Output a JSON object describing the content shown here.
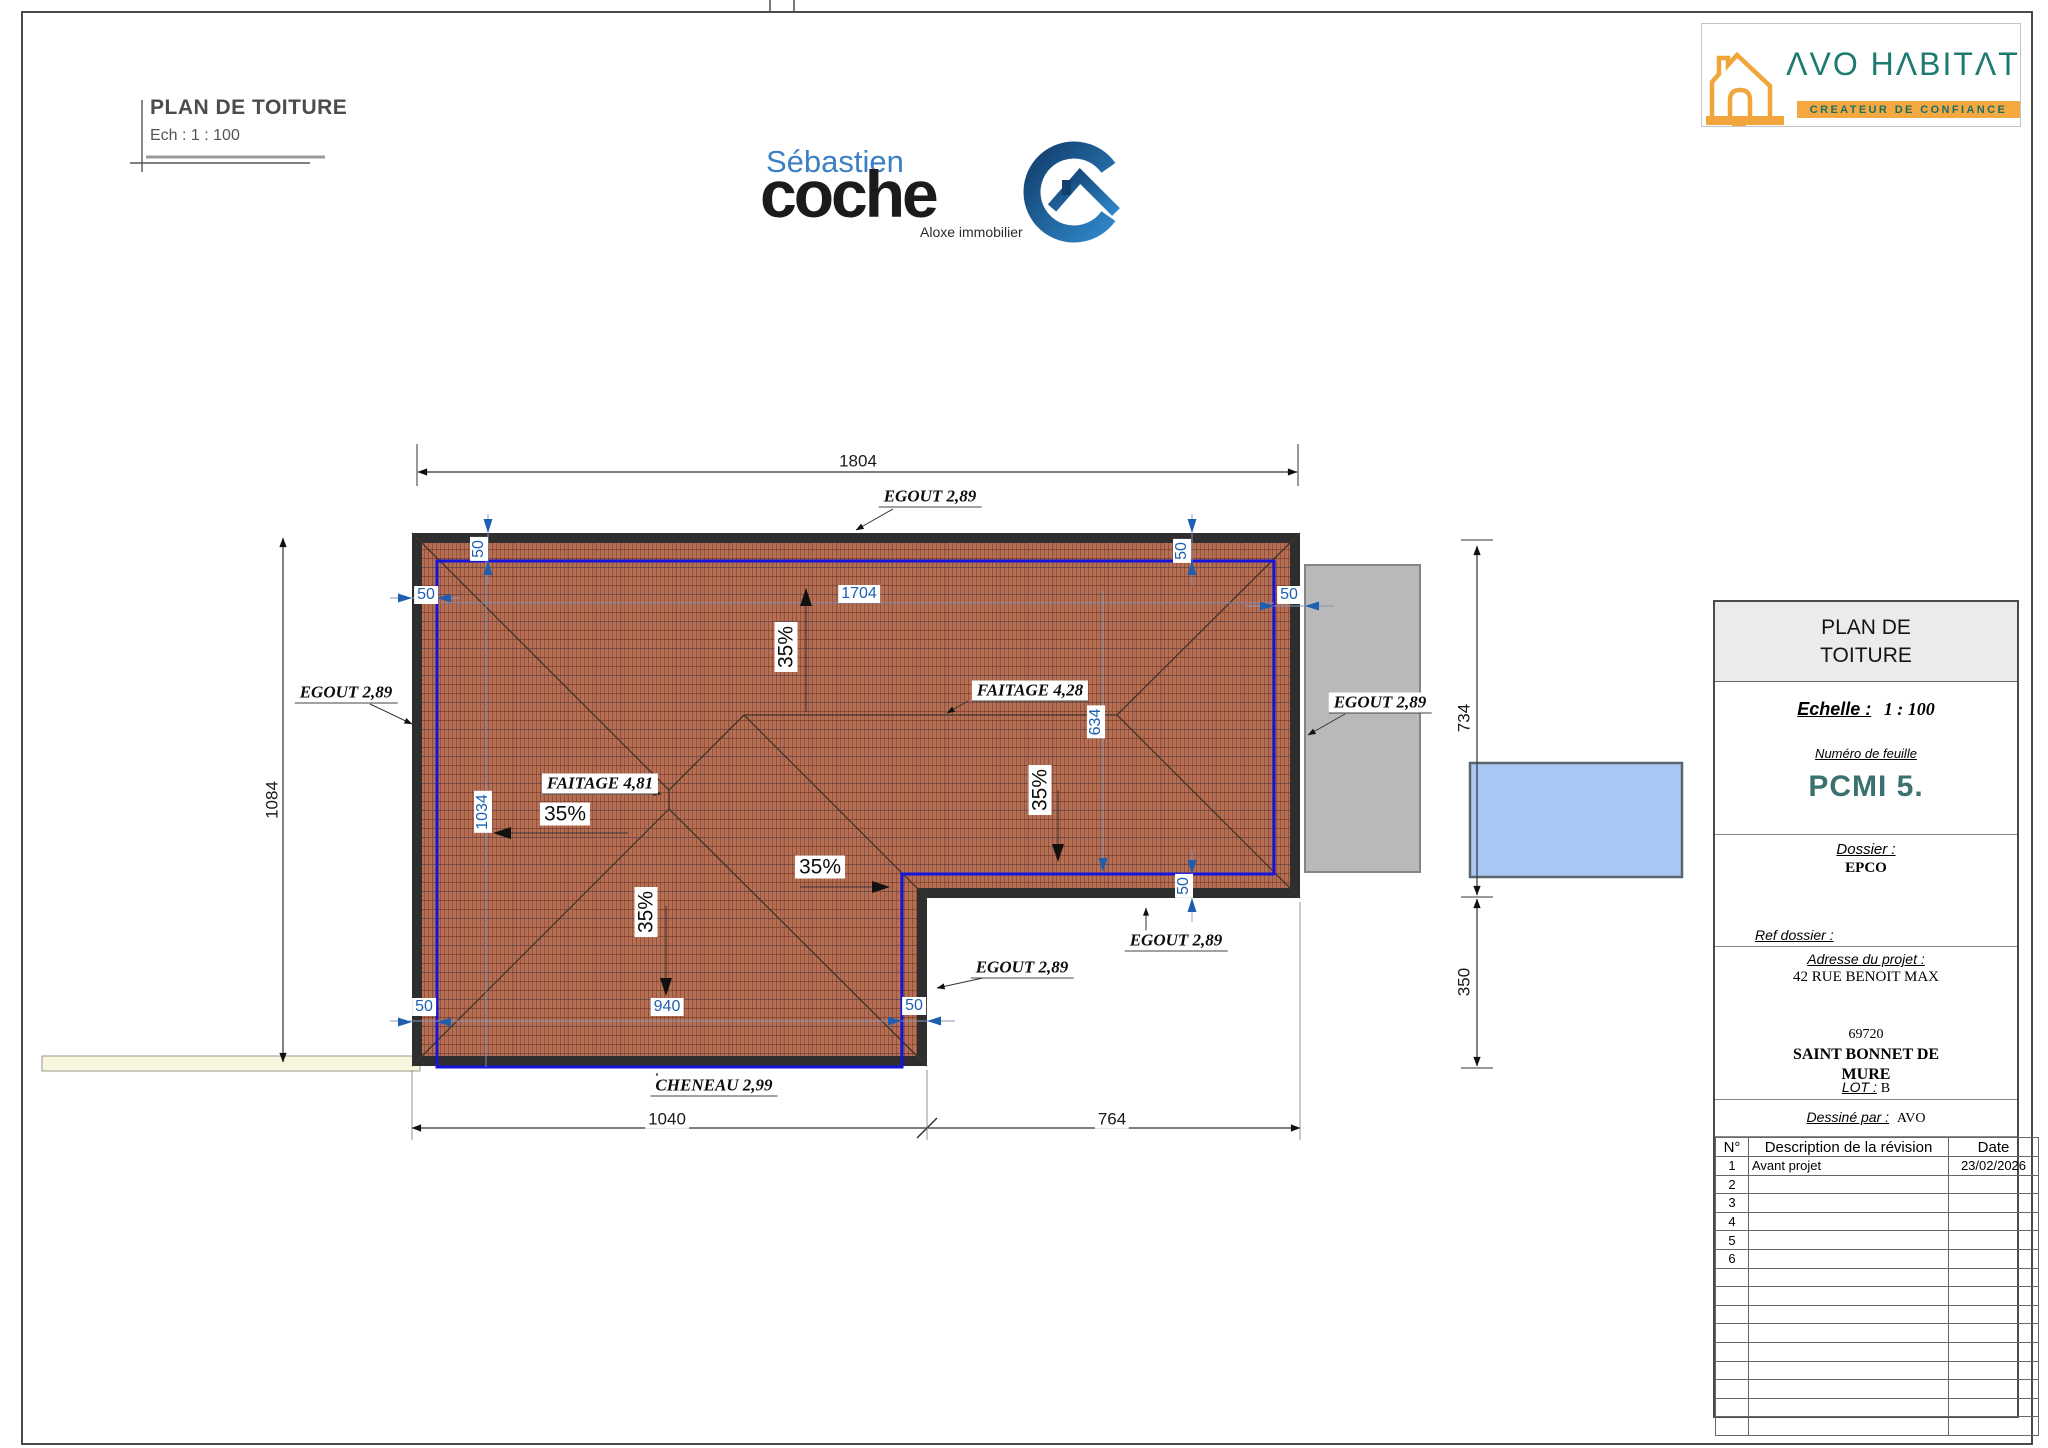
{
  "corner": {
    "title": "PLAN DE TOITURE",
    "scale": "Ech :  1 : 100"
  },
  "coche": {
    "top": "Sébastien",
    "main": "coche",
    "sub": "Aloxe immobilier"
  },
  "avo": {
    "name": "ΛVO HΛBITΛT",
    "tagline": "CREATEUR DE CONFIANCE"
  },
  "plan": {
    "dims": {
      "total_width": "1804",
      "total_height": "1084",
      "right_upper": "734",
      "right_lower": "350",
      "bottom_left": "1040",
      "bottom_right": "764"
    },
    "inner": {
      "top": "1704",
      "left": "1034",
      "right": "634",
      "bottom": "940",
      "offset": "50"
    },
    "ann": {
      "egout": "EGOUT 2,89",
      "faitage1": "FAITAGE 4,81",
      "faitage2": "FAITAGE 4,28",
      "cheneau": "CHENEAU 2,99",
      "slope": "35%"
    }
  },
  "tb": {
    "title": "PLAN DE TOITURE",
    "scale_label": "Echelle :",
    "scale_value": "1 : 100",
    "sheet_label": "Numéro de feuille",
    "sheet_number": "PCMI 5.",
    "dossier_label": "Dossier :",
    "dossier_value": "EPCO",
    "ref_label": "Ref dossier :",
    "addr_label": "Adresse du projet :",
    "addr1": "42 RUE BENOIT MAX",
    "zip": "69720",
    "city": "SAINT BONNET DE MURE",
    "lot_label": "LOT :",
    "lot_value": "B",
    "author_label": "Dessiné par :",
    "author_value": "AVO",
    "rev_head": {
      "n": "N°",
      "desc": "Description de la révision",
      "date": "Date"
    },
    "revisions": [
      {
        "n": "1",
        "desc": "Avant projet",
        "date": "23/02/2026"
      },
      {
        "n": "2",
        "desc": "",
        "date": ""
      },
      {
        "n": "3",
        "desc": "",
        "date": ""
      },
      {
        "n": "4",
        "desc": "",
        "date": ""
      },
      {
        "n": "5",
        "desc": "",
        "date": ""
      },
      {
        "n": "6",
        "desc": "",
        "date": ""
      }
    ]
  },
  "colors": {
    "roof_tile": "#b76f53",
    "roof_edge": "#2e2e2e",
    "wall_line_blue": "#1414dd",
    "dim_blue": "#1d5fae",
    "teal": "#1d7a71",
    "orange": "#f3a93f",
    "pool_blue": "#a9c9f4"
  }
}
